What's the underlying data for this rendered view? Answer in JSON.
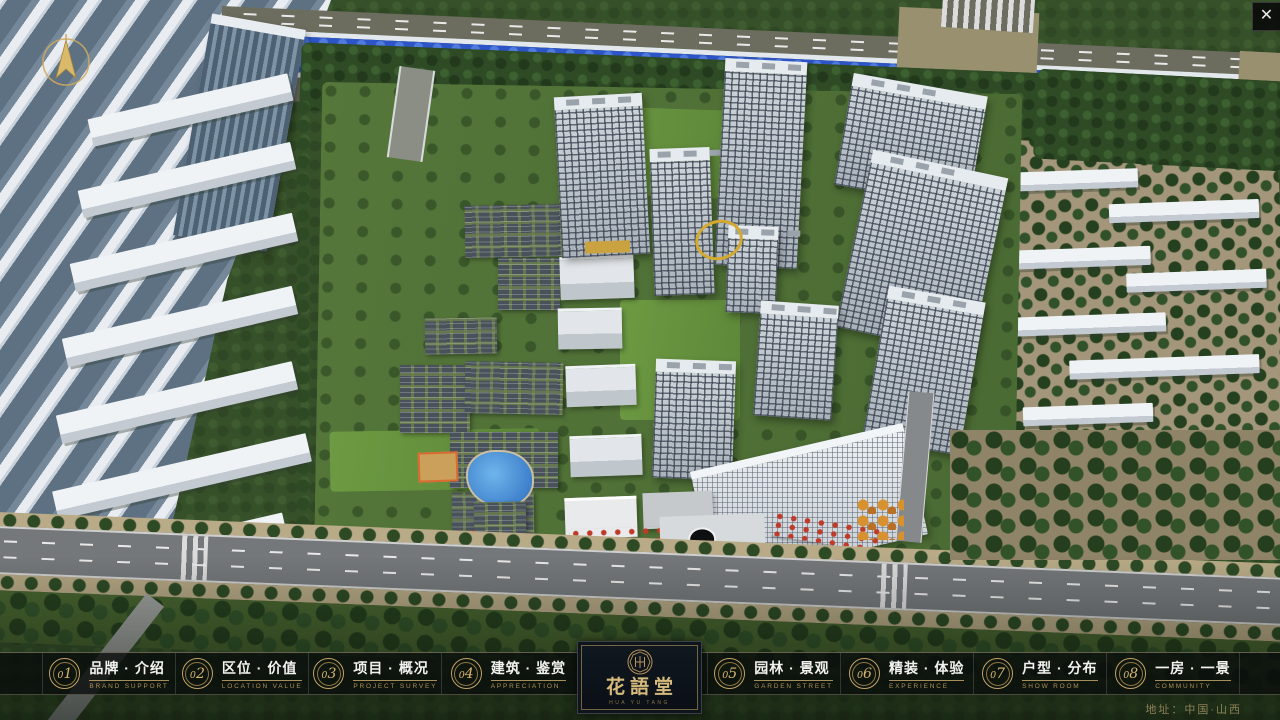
{
  "window": {
    "close_label": "✕"
  },
  "nav": {
    "items": [
      {
        "id": "brand",
        "num": "01",
        "zh": "品牌 · 介绍",
        "en": "BRAND SUPPORT"
      },
      {
        "id": "location",
        "num": "02",
        "zh": "区位 · 价值",
        "en": "LOCATION VALUE"
      },
      {
        "id": "project",
        "num": "03",
        "zh": "项目 · 概况",
        "en": "PROJECT SURVEY"
      },
      {
        "id": "architecture",
        "num": "04",
        "zh": "建筑 · 鉴赏",
        "en": "APPRECIATION"
      },
      {
        "id": "garden",
        "num": "05",
        "zh": "园林 · 景观",
        "en": "GARDEN STREET"
      },
      {
        "id": "decoration",
        "num": "06",
        "zh": "精装 · 体验",
        "en": "EXPERIENCE"
      },
      {
        "id": "layout",
        "num": "07",
        "zh": "户型 · 分布",
        "en": "SHOW ROOM"
      },
      {
        "id": "room-view",
        "num": "08",
        "zh": "一房 · 一景",
        "en": "COMMUNITY"
      }
    ]
  },
  "logo": {
    "title": "花語堂",
    "caption": "HUA YU TANG"
  },
  "footer": {
    "address": "地址：中国·山西"
  },
  "colors": {
    "gold": "#c2a368",
    "panel_navy": "#0c141d",
    "river_blue": "#2d55c8",
    "bar_bg": "rgba(9,13,11,0.8)"
  }
}
